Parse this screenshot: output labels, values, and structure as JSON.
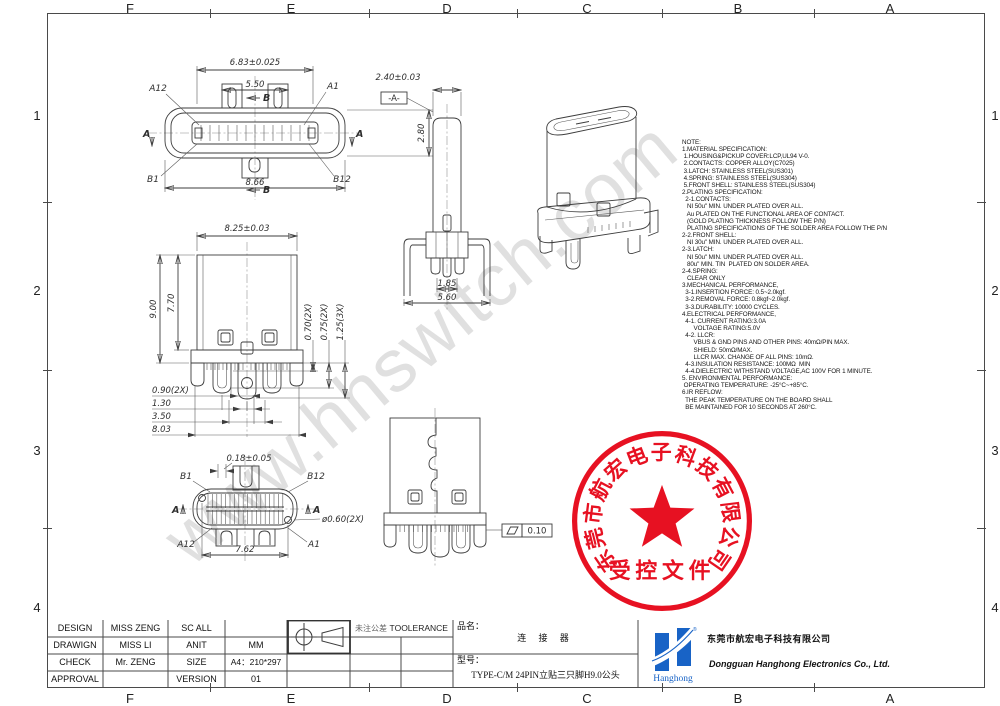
{
  "frame": {
    "cols": [
      "F",
      "E",
      "D",
      "C",
      "B",
      "A"
    ],
    "rows": [
      "1",
      "2",
      "3",
      "4"
    ]
  },
  "watermark": "www.hhswitch.com",
  "notes": "NOTE:\n1.MATERIAL SPECIFICATION:\n 1.HOUSING&PICKUP COVER:LCP,UL94 V-0.\n 2.CONTACTS: COPPER ALLOY(C7025)\n 3.LATCH: STAINLESS STEEL(SUS301)\n 4.SPRING: STAINLESS STEEL(SUS304)\n 5.FRONT SHELL: STAINLESS STEEL(SUS304)\n2.PLATING SPECIFICATION:\n  2-1.CONTACTS:\n   NI 50u\" MIN. UNDER PLATED OVER ALL.\n   Au PLATED ON THE FUNCTIONAL AREA OF CONTACT.\n   (GOLD PLATING THICKNESS FOLLOW THE P/N)\n   PLATING SPECIFICATIONS OF THE SOLDER AREA FOLLOW THE P/N\n2-2.FRONT SHELL:\n   NI 30u\" MIN. UNDER PLATED OVER ALL.\n2-3.LATCH:\n   NI 50u\" MIN. UNDER PLATED OVER ALL.\n   80u\" MIN. TIN  PLATED ON SOLDER AREA.\n2-4.SPRING:\n   CLEAR ONLY\n3.MECHANICAL PERFORMANCE,\n  3-1.INSERTION FORCE: 0.5~2.0kgf.\n  3-2.REMOVAL FORCE: 0.8kgf~2.0kgf.\n  3-3.DURABILITY: 10000 CYCLES.\n4.ELECTRICAL PERFORMANCE,\n  4-1. CURRENT RATING:3.0A\n       VOLTAGE RATING:5.0V\n  4-2. LLCR:\n       VBUS & GND PINS AND OTHER PINS: 40mΩ/PIN MAX.\n       SHIELD: 50mΩ/MAX.\n       LLCR MAX. CHANGE OF ALL PINS: 10mΩ.\n  4-3.INSULATION RESISTANCE: 100MΩ  MIN\n  4-4.DIELECTRIC WITHSTAND VOLTAGE,AC 100V FOR 1 MINUTE.\n5. ENVIRONMENTAL PERFORMANCE:\n OPERATING TEMPERATURE: -25°C~+85°C.\n6.IR REFLOW:\n  THE PEAK TEMPERATURE ON THE BOARD SHALL\n  BE MAINTAINED FOR 10 SECONDS AT 260°C.",
  "stamp": {
    "arc": "东莞市航宏电子科技有限公司",
    "label": "受控文件"
  },
  "views": {
    "front": {
      "w_outer": "6.83±0.025",
      "w_inner": "5.50",
      "h": "2.80",
      "w_total": "8.66",
      "a12": "A12",
      "a1": "A1",
      "b1": "B1",
      "b12": "B12",
      "sec_a": "A",
      "sec_b": "B"
    },
    "side": {
      "w": "2.40±0.03",
      "datum": "-A-",
      "pitch": "1.85",
      "span": "5.60"
    },
    "front2": {
      "w": "8.25±0.03",
      "h_total": "9.00",
      "h_body": "7.70",
      "r1": "0.70(2X)",
      "r2": "0.75(2X)",
      "r3": "1.25(3X)",
      "b1": "0.90(2X)",
      "b2": "1.30",
      "b3": "3.50",
      "b4": "8.03"
    },
    "bottom": {
      "slot": "0.18±0.05",
      "b1": "B1",
      "b12": "B12",
      "a12": "A12",
      "a1": "A1",
      "hole": "ø0.60(2X)",
      "span": "7.62",
      "sec_a": "A"
    },
    "back": {
      "flatness": "0.10"
    }
  },
  "title_block": {
    "rows": [
      {
        "label": "DESIGN",
        "name": "MISS ZENG",
        "label2": "SC ALL",
        "value": ""
      },
      {
        "label": "DRAWIGN",
        "name": "MISS LI",
        "label2": "ANIT",
        "value": "MM"
      },
      {
        "label": "CHECK",
        "name": "Mr. ZENG",
        "label2": "SIZE",
        "value": "A4：210*297"
      },
      {
        "label": "APPROVAL",
        "name": "",
        "label2": "VERSION",
        "value": "01"
      }
    ],
    "tol_cn": "未注公差",
    "tol_en": "TOOLERANCE",
    "part_label": "品名：",
    "part_name": "连 接 器",
    "model_label": "型号：",
    "model": "TYPE-C/M 24PIN立贴三只脚H9.0公头",
    "logo_text": "Hanghong",
    "reg": "®",
    "company_cn": "东莞市航宏电子科技有限公司",
    "company_en": "Dongguan Hanghong Electronics Co., Ltd."
  },
  "colors": {
    "red": "#e60012",
    "blue": "#1863c6",
    "line": "#3d3d3d",
    "watermark": "#d9d9d9"
  }
}
